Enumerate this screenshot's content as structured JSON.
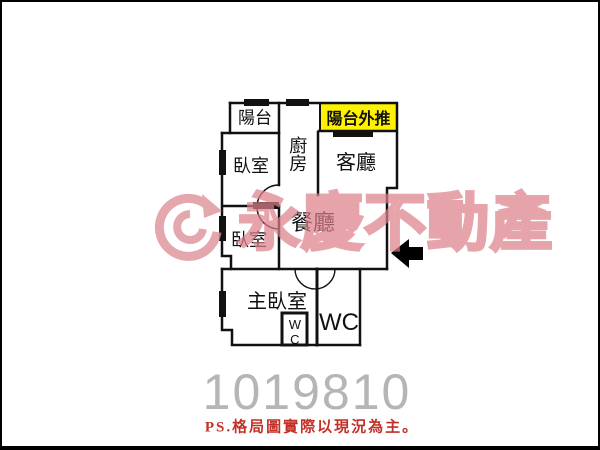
{
  "labels": {
    "balcony": "陽台",
    "balcony_pushed": "陽台外推",
    "kitchen": "廚房",
    "living_room": "客廳",
    "bedroom_1": "臥室",
    "dining_room": "餐廳",
    "bedroom_2": "臥室",
    "master_bedroom": "主臥室",
    "wc": "WC",
    "wc_small": "WC"
  },
  "watermark": {
    "brand": "永慶不動產",
    "color": "#DD8F98"
  },
  "listing_number": "1019810",
  "footnote": "PS.格局圖實際以現況為主。",
  "colors": {
    "wall": "#111111",
    "highlight": "#FFF200",
    "listing_number": "#B5B5B5",
    "footnote_red": "#C23127",
    "arrow": "#000000"
  }
}
